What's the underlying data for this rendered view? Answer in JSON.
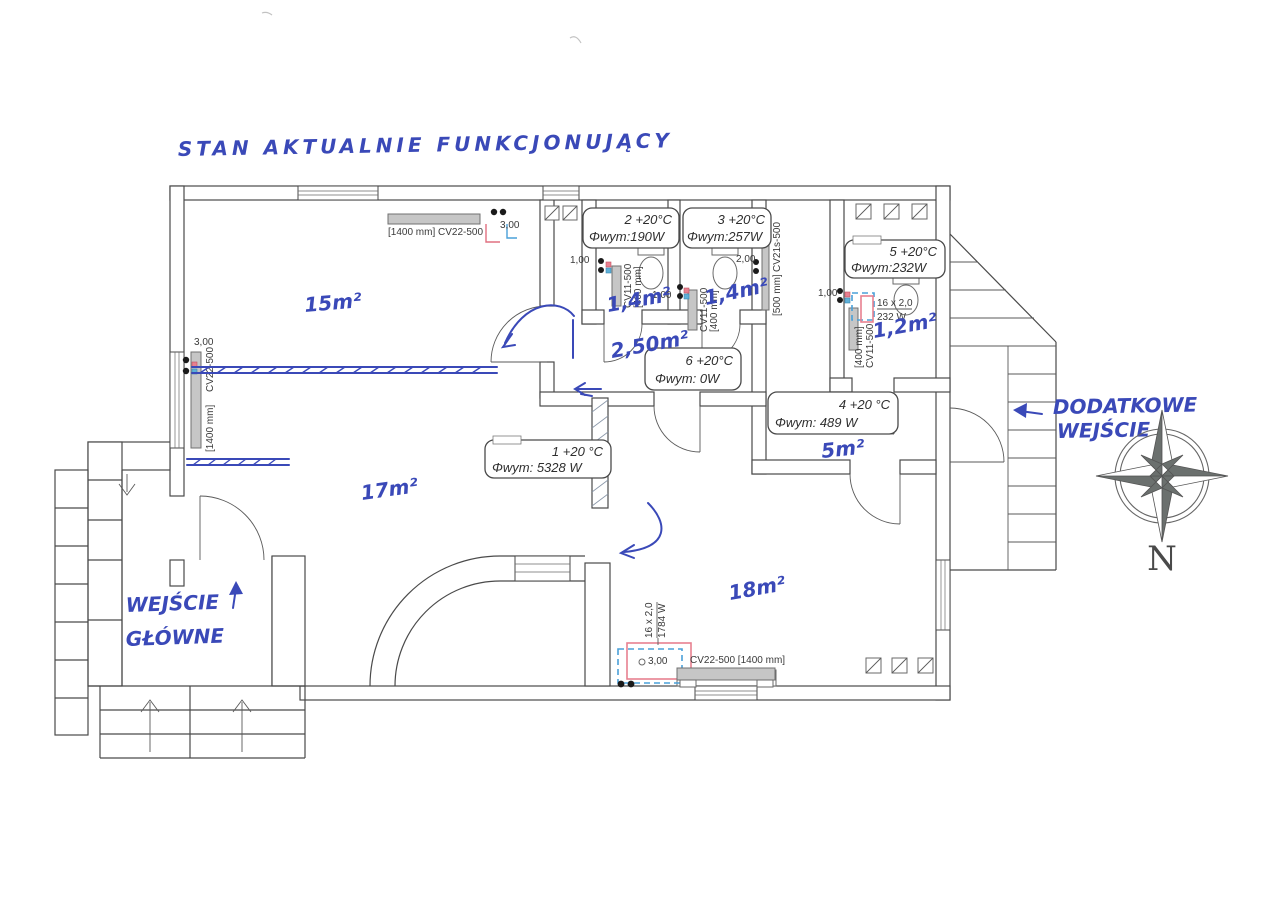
{
  "title": "STAN AKTUALNIE FUNKCJONUJĄCY",
  "colors": {
    "handwriting_blue": "#3a49b8",
    "wall_ink": "#4a4a4a",
    "pipe_red": "#e07080",
    "pipe_blue": "#4aa0d8",
    "radiator_fill": "#c6c6c6"
  },
  "room_boxes": [
    {
      "number": "1",
      "line1": "1 +20 °C",
      "line2": "Φwym: 5328 W"
    },
    {
      "number": "2",
      "line1": "2 +20°C",
      "line2": "Φwym:190W"
    },
    {
      "number": "3",
      "line1": "3 +20°C",
      "line2": "Φwym:257W"
    },
    {
      "number": "4",
      "line1": "4 +20 °C",
      "line2": "Φwym: 489 W"
    },
    {
      "number": "5",
      "line1": "5 +20°C",
      "line2": "Φwym:232W"
    },
    {
      "number": "6",
      "line1": "6 +20°C",
      "line2": "Φwym: 0W"
    }
  ],
  "areas": {
    "topleft": "15m²",
    "bottomleft": "17m²",
    "wc2": "1,4m²",
    "wc3": "1,4m²",
    "hall6": "2,50m²",
    "wc5": "1,2m²",
    "hall4": "5m²",
    "bottomright": "18m²"
  },
  "entrances": {
    "main_line1": "WEJŚCIE",
    "main_line2": "GŁÓWNE",
    "side_line1": "DODATKOWE",
    "side_line2": "WEJŚCIE"
  },
  "radiators": {
    "top_label": "[1400 mm] CV22-500",
    "left_model": "CV22-500",
    "left_size": "[1400 mm]",
    "wc2_model": "CV11-500",
    "wc2_size": "[400 mm]",
    "wc3_model": "CV11-500",
    "wc3_size": "[400 mm]",
    "corridor_model": "CV21s-500",
    "corridor_size": "[500 mm]",
    "wc5_model": "CV11-500",
    "wc5_size": "[400 mm]",
    "bottom_label": "CV22-500 [1400 mm]"
  },
  "floor_loops": {
    "small_size": "16 x 2,0",
    "small_power": "232 W",
    "large_size": "16 x 2,0",
    "large_power": "1784 W"
  },
  "dimensions": {
    "top": "3,00",
    "left": "3,00",
    "wc2": "1,00",
    "wc3": "1,00",
    "corridor": "2,00",
    "wc5": "1,00",
    "bottom": "3,00"
  },
  "compass": {
    "north": "N"
  }
}
